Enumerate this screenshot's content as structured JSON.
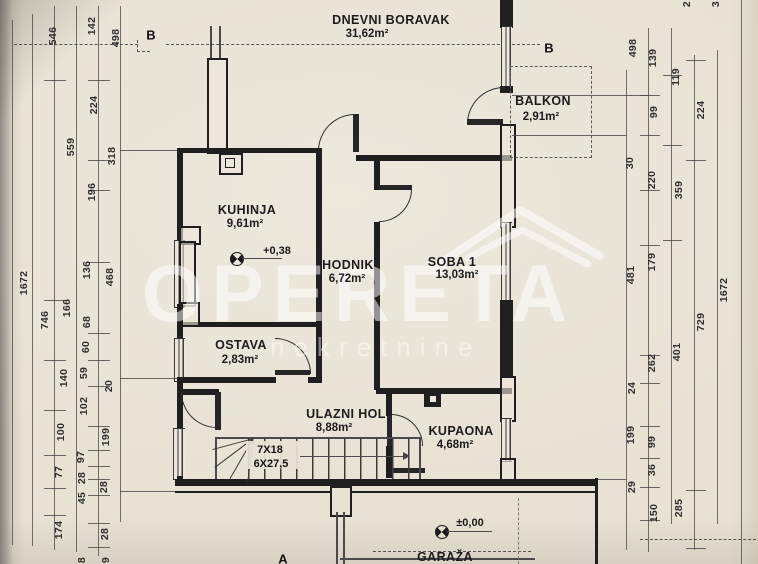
{
  "rooms": [
    {
      "name": "DNEVNI BORAVAK",
      "area": "31,62m²",
      "nx": 391,
      "ny": 20,
      "ax": 367,
      "ay": 34
    },
    {
      "name": "BALKON",
      "area": "2,91m²",
      "nx": 543,
      "ny": 101,
      "ax": 541,
      "ay": 117
    },
    {
      "name": "KUHINJA",
      "area": "9,61m²",
      "nx": 247,
      "ny": 210,
      "ax": 245,
      "ay": 224
    },
    {
      "name": "HODNIK",
      "area": "6,72m²",
      "nx": 348,
      "ny": 265,
      "ax": 347,
      "ay": 279
    },
    {
      "name": "SOBA 1",
      "area": "13,03m²",
      "nx": 452,
      "ny": 262,
      "ax": 457,
      "ay": 275
    },
    {
      "name": "OSTAVA",
      "area": "2,83m²",
      "nx": 241,
      "ny": 345,
      "ax": 240,
      "ay": 360
    },
    {
      "name": "ULAZNI HOL",
      "area": "8,88m²",
      "nx": 346,
      "ny": 414,
      "ax": 334,
      "ay": 428
    },
    {
      "name": "KUPAONA",
      "area": "4,68m²",
      "nx": 461,
      "ny": 431,
      "ax": 455,
      "ay": 445
    },
    {
      "name": "GARAŽA",
      "area": "",
      "nx": 445,
      "ny": 557,
      "ax": 445,
      "ay": 570
    }
  ],
  "levels": [
    {
      "label": "+0,38",
      "tx": 277,
      "ty": 251,
      "sx": 230,
      "sy": 252,
      "ux": 242,
      "uy": 258,
      "uw": 40
    },
    {
      "label": "±0,00",
      "tx": 470,
      "ty": 523,
      "sx": 435,
      "sy": 525,
      "ux": 447,
      "uy": 531,
      "uw": 45
    }
  ],
  "stairs": {
    "line1": "7X18",
    "line2": "6X27,5"
  },
  "markers": {
    "section_b_left": "B",
    "section_b_right": "B",
    "section_a": "A"
  },
  "watermark": {
    "word": "OPERETA",
    "sub": "nekretnine"
  },
  "dims_left": [
    {
      "v": "546",
      "x": 53,
      "y": 36
    },
    {
      "v": "142",
      "x": 92,
      "y": 26
    },
    {
      "v": "498",
      "x": 116,
      "y": 38
    },
    {
      "v": "224",
      "x": 94,
      "y": 105
    },
    {
      "v": "559",
      "x": 71,
      "y": 147
    },
    {
      "v": "318",
      "x": 112,
      "y": 156
    },
    {
      "v": "196",
      "x": 92,
      "y": 192
    },
    {
      "v": "1672",
      "x": 24,
      "y": 283
    },
    {
      "v": "746",
      "x": 45,
      "y": 320
    },
    {
      "v": "166",
      "x": 67,
      "y": 308
    },
    {
      "v": "136",
      "x": 87,
      "y": 270
    },
    {
      "v": "468",
      "x": 110,
      "y": 277
    },
    {
      "v": "68",
      "x": 87,
      "y": 322
    },
    {
      "v": "60",
      "x": 86,
      "y": 347
    },
    {
      "v": "59",
      "x": 84,
      "y": 373
    },
    {
      "v": "140",
      "x": 64,
      "y": 378
    },
    {
      "v": "20",
      "x": 109,
      "y": 386
    },
    {
      "v": "102",
      "x": 84,
      "y": 406
    },
    {
      "v": "100",
      "x": 61,
      "y": 432
    },
    {
      "v": "199",
      "x": 106,
      "y": 437
    },
    {
      "v": "97",
      "x": 81,
      "y": 457
    },
    {
      "v": "77",
      "x": 59,
      "y": 472
    },
    {
      "v": "28",
      "x": 82,
      "y": 478
    },
    {
      "v": "45",
      "x": 82,
      "y": 498
    },
    {
      "v": "28",
      "x": 104,
      "y": 487
    },
    {
      "v": "174",
      "x": 59,
      "y": 530
    },
    {
      "v": "28",
      "x": 105,
      "y": 534
    },
    {
      "v": "8",
      "x": 82,
      "y": 560
    },
    {
      "v": "9",
      "x": 106,
      "y": 560
    }
  ],
  "dims_right": [
    {
      "v": "2",
      "x": 687,
      "y": 4
    },
    {
      "v": "3",
      "x": 716,
      "y": 4
    },
    {
      "v": "498",
      "x": 633,
      "y": 48
    },
    {
      "v": "139",
      "x": 653,
      "y": 58
    },
    {
      "v": "119",
      "x": 676,
      "y": 77
    },
    {
      "v": "99",
      "x": 654,
      "y": 112
    },
    {
      "v": "224",
      "x": 701,
      "y": 110
    },
    {
      "v": "30",
      "x": 630,
      "y": 163
    },
    {
      "v": "220",
      "x": 652,
      "y": 180
    },
    {
      "v": "359",
      "x": 679,
      "y": 190
    },
    {
      "v": "179",
      "x": 652,
      "y": 262
    },
    {
      "v": "481",
      "x": 631,
      "y": 275
    },
    {
      "v": "1672",
      "x": 724,
      "y": 290
    },
    {
      "v": "729",
      "x": 701,
      "y": 322
    },
    {
      "v": "401",
      "x": 677,
      "y": 352
    },
    {
      "v": "262",
      "x": 652,
      "y": 363
    },
    {
      "v": "24",
      "x": 632,
      "y": 388
    },
    {
      "v": "199",
      "x": 631,
      "y": 435
    },
    {
      "v": "99",
      "x": 652,
      "y": 442
    },
    {
      "v": "36",
      "x": 652,
      "y": 470
    },
    {
      "v": "29",
      "x": 632,
      "y": 487
    },
    {
      "v": "285",
      "x": 679,
      "y": 508
    },
    {
      "v": "150",
      "x": 654,
      "y": 513
    }
  ],
  "dim_lines": [
    {
      "x": 12,
      "y1": 20,
      "y2": 545
    },
    {
      "x": 32,
      "y1": 14,
      "y2": 546
    },
    {
      "x": 54,
      "y1": 6,
      "y2": 550
    },
    {
      "x": 76,
      "y1": 6,
      "y2": 552
    },
    {
      "x": 98,
      "y1": 6,
      "y2": 556
    },
    {
      "x": 120,
      "y1": 6,
      "y2": 522
    },
    {
      "x": 626,
      "y1": 70,
      "y2": 550
    },
    {
      "x": 648,
      "y1": 28,
      "y2": 552
    },
    {
      "x": 671,
      "y1": 28,
      "y2": 524
    },
    {
      "x": 694,
      "y1": 55,
      "y2": 550
    },
    {
      "x": 717,
      "y1": 50,
      "y2": 524
    },
    {
      "x": 741,
      "y1": 0,
      "y2": 564
    }
  ],
  "dim_ticks": [
    {
      "x1": 88,
      "x2": 110,
      "y": 80
    },
    {
      "x1": 88,
      "x2": 110,
      "y": 160
    },
    {
      "x1": 88,
      "x2": 110,
      "y": 190
    },
    {
      "x1": 88,
      "x2": 110,
      "y": 262
    },
    {
      "x1": 88,
      "x2": 110,
      "y": 333
    },
    {
      "x1": 88,
      "x2": 110,
      "y": 360
    },
    {
      "x1": 88,
      "x2": 110,
      "y": 386
    },
    {
      "x1": 88,
      "x2": 110,
      "y": 426
    },
    {
      "x1": 88,
      "x2": 110,
      "y": 450
    },
    {
      "x1": 88,
      "x2": 110,
      "y": 466
    },
    {
      "x1": 88,
      "x2": 110,
      "y": 479
    },
    {
      "x1": 88,
      "x2": 110,
      "y": 495
    },
    {
      "x1": 88,
      "x2": 110,
      "y": 523
    },
    {
      "x1": 88,
      "x2": 110,
      "y": 547
    },
    {
      "x1": 44,
      "x2": 66,
      "y": 80
    },
    {
      "x1": 44,
      "x2": 66,
      "y": 300
    },
    {
      "x1": 44,
      "x2": 66,
      "y": 360
    },
    {
      "x1": 44,
      "x2": 66,
      "y": 410
    },
    {
      "x1": 44,
      "x2": 66,
      "y": 455
    },
    {
      "x1": 44,
      "x2": 66,
      "y": 488
    },
    {
      "x1": 44,
      "x2": 66,
      "y": 515
    },
    {
      "x1": 640,
      "x2": 660,
      "y": 95
    },
    {
      "x1": 640,
      "x2": 660,
      "y": 135
    },
    {
      "x1": 640,
      "x2": 660,
      "y": 190
    },
    {
      "x1": 640,
      "x2": 660,
      "y": 245
    },
    {
      "x1": 640,
      "x2": 660,
      "y": 355
    },
    {
      "x1": 640,
      "x2": 660,
      "y": 383
    },
    {
      "x1": 640,
      "x2": 660,
      "y": 426
    },
    {
      "x1": 640,
      "x2": 660,
      "y": 458
    },
    {
      "x1": 640,
      "x2": 660,
      "y": 487
    },
    {
      "x1": 640,
      "x2": 660,
      "y": 520
    },
    {
      "x1": 663,
      "x2": 682,
      "y": 75
    },
    {
      "x1": 663,
      "x2": 682,
      "y": 145
    },
    {
      "x1": 663,
      "x2": 682,
      "y": 240
    },
    {
      "x1": 686,
      "x2": 706,
      "y": 60
    },
    {
      "x1": 686,
      "x2": 706,
      "y": 160
    },
    {
      "x1": 686,
      "x2": 706,
      "y": 490
    },
    {
      "x1": 686,
      "x2": 706,
      "y": 548
    },
    {
      "x1": 120,
      "x2": 177,
      "y": 150
    },
    {
      "x1": 120,
      "x2": 177,
      "y": 378
    },
    {
      "x1": 120,
      "x2": 175,
      "y": 491
    },
    {
      "x1": 598,
      "x2": 626,
      "y": 479
    },
    {
      "x1": 512,
      "x2": 648,
      "y": 95
    },
    {
      "x1": 512,
      "x2": 626,
      "y": 135
    }
  ],
  "colors": {
    "paper": "#e7e2d4",
    "line": "#1f1f1f",
    "dim_text": "#2e2e2e",
    "watermark": "rgba(255,255,255,0.52)"
  }
}
